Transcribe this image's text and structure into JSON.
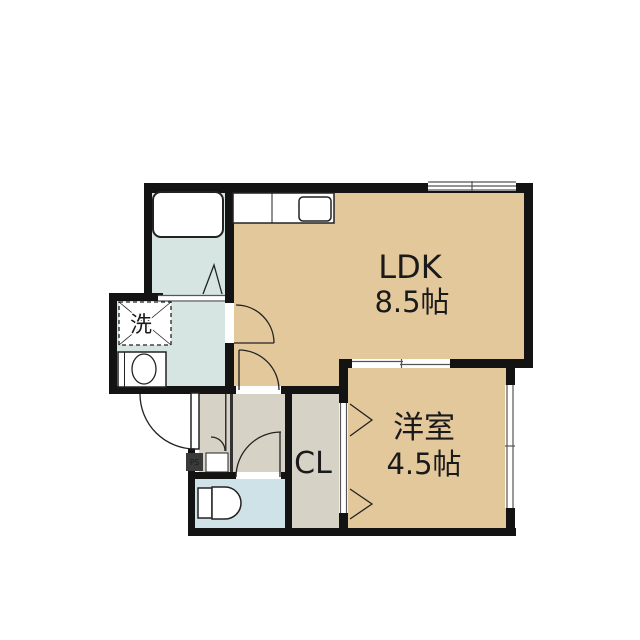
{
  "floorplan": {
    "rooms": {
      "ldk": {
        "label": "LDK",
        "area": "8.5帖"
      },
      "western_room": {
        "label": "洋室",
        "area": "4.5帖"
      },
      "closet": {
        "label": "CL"
      },
      "washer_space": {
        "label": "洗"
      },
      "pipe_space": {
        "label": "PS"
      }
    },
    "colors": {
      "room_tan": "#e3c89c",
      "wet_cyan": "#d6e5e2",
      "toilet_blue": "#cfe2e8",
      "hall_gray": "#d6d2c6",
      "wall": "#131313",
      "line": "#222222",
      "ps_box": "#3a3a3a"
    }
  }
}
